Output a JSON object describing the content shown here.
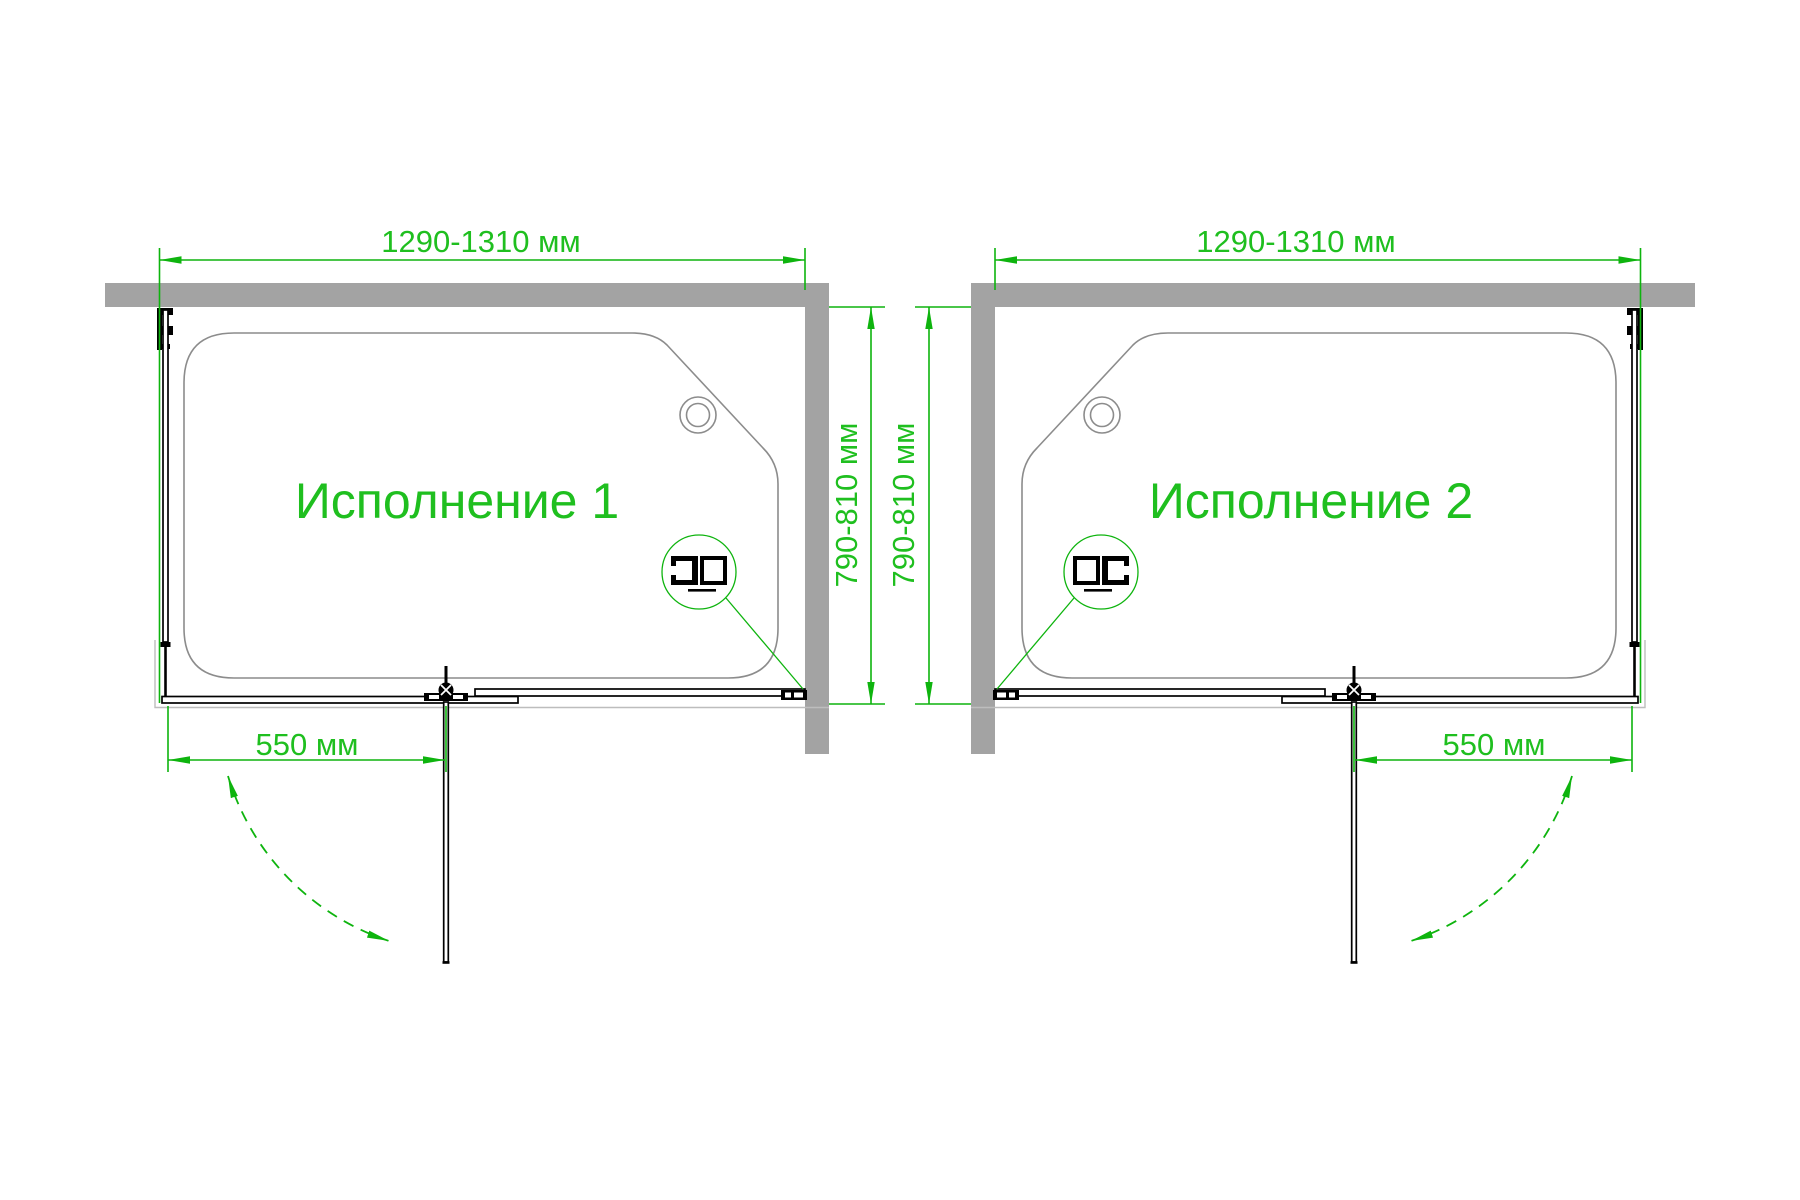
{
  "page": {
    "background": "#FFFFFF",
    "drawing_type": "plan-view technical drawing, two mirrored variants of a shower screen mounted on a bathtub"
  },
  "colors": {
    "dimension_green": "#0EB40E",
    "text_green": "#1FBF1F",
    "wall_gray": "#A3A3A3",
    "bathtub_outline_gray": "#8C8C8C",
    "frame_black": "#000000"
  },
  "icons": {
    "drain": "double-circle",
    "hinge": "pivot-circle-with-cross",
    "profile_detail": "magnifier-circle-with-profile-cross-section",
    "door_swing": "dashed-arc-with-arrowheads"
  },
  "diagrams": [
    {
      "label": "Исполнение 1",
      "width_dimension": "1290-1310 мм",
      "depth_dimension": "790-810 мм",
      "door_width_dimension": "550 мм"
    },
    {
      "label": "Исполнение 2",
      "width_dimension": "1290-1310 мм",
      "depth_dimension": "790-810 мм",
      "door_width_dimension": "550 мм"
    }
  ]
}
